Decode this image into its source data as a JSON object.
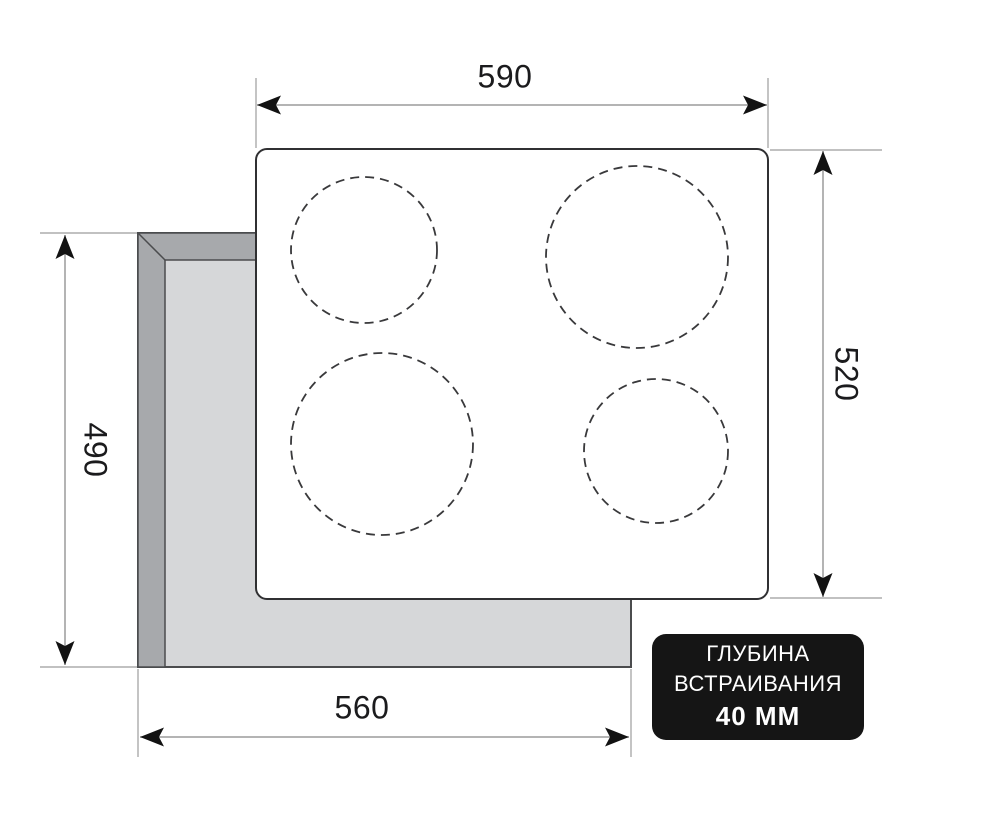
{
  "diagram": {
    "title": "built-in hob installation dimensions drawing",
    "dimensions": {
      "top_width": "590",
      "right_height": "520",
      "left_height": "490",
      "bottom_width": "560"
    },
    "badge": {
      "line1": "ГЛУБИНА",
      "line2": "ВСТРАИВАНИЯ",
      "line3": "40 ММ"
    },
    "burners": [
      {
        "name": "rear-left",
        "cx": 364,
        "cy": 250,
        "r": 73
      },
      {
        "name": "rear-right",
        "cx": 637,
        "cy": 257,
        "r": 91
      },
      {
        "name": "front-left",
        "cx": 382,
        "cy": 444,
        "r": 91
      },
      {
        "name": "front-right",
        "cx": 656,
        "cy": 451,
        "r": 72
      }
    ],
    "colors": {
      "panel_light": "#d6d7d9",
      "panel_dark": "#a7a9ac",
      "panel_outline": "#4b4c4e",
      "cooktop_outline": "#303032",
      "burner_outline": "#39393b",
      "dimension_line": "#9c9c9c",
      "arrow": "#121212",
      "label_text": "#1b1b1d",
      "badge_bg": "#151515",
      "badge_text": "#ffffff"
    }
  }
}
